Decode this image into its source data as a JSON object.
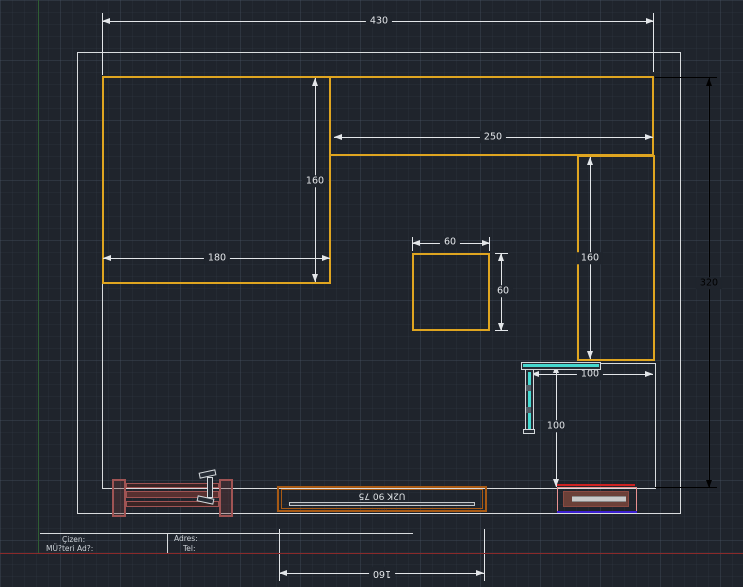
{
  "drawing": {
    "dim_top_width": "430",
    "dim_band_width": "250",
    "dim_left_height": "160",
    "dim_left_width": "180",
    "dim_island_width": "60",
    "dim_island_height": "60",
    "dim_right_height": "160",
    "dim_total_height": "320",
    "dim_corner_width": "100",
    "dim_corner_height": "100",
    "dim_bottom_width": "160",
    "cabinet_label": "U2K 90 75",
    "cabinet_marks": "·····"
  },
  "title_block": {
    "drawer_label": "Çizen:",
    "customer_label": "MÜ?teri Ad?:",
    "address_label": "Adres:",
    "phone_label": "Tel:"
  },
  "colors": {
    "background": "#1f242c",
    "wall": "#d9dcde",
    "cabinet_orange": "#dfa520",
    "cabinet_brown": "#a85a14",
    "dimension_white": "#e3e6e9",
    "dimension_black": "#000000",
    "axis_green": "#2f5e33",
    "divider_red": "#8a2a2a",
    "glass_cyan": "#45d8cf",
    "furniture_red": "#a05454",
    "radiator_blue": "#3b1fd0"
  }
}
